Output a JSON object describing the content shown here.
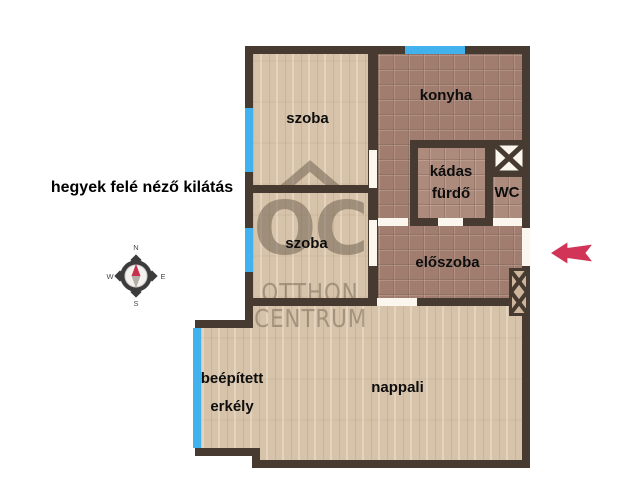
{
  "title": "floor-plan",
  "notes": {
    "view": "hegyek felé néző kilátás"
  },
  "rooms": {
    "szoba1": "szoba",
    "szoba2": "szoba",
    "konyha": "konyha",
    "furdo_line1": "kádas",
    "furdo_line2": "fürdő",
    "wc": "WC",
    "eloszoba": "előszoba",
    "nappali": "nappali",
    "erkely_line1": "beépített",
    "erkely_line2": "erkély"
  },
  "compass": {
    "n": "N",
    "e": "E",
    "s": "S",
    "w": "W"
  },
  "watermark": {
    "logo": "OC",
    "line1": "OTTHON",
    "line2": "CENTRUM"
  },
  "icons": {
    "entrance_arrow": "left-arrow",
    "shaft_top": "x-box-shaft",
    "shaft_right": "x-box-shaft",
    "compass_needle": "north-needle"
  },
  "colors": {
    "wall": "#473a30",
    "window": "#41b2ee",
    "wood_floor": "#d7c3a9",
    "tile_floor": "#a17d6f",
    "door_opening": "#fbf7ee",
    "entrance_arrow": "#d23457",
    "background": "#ffffff"
  }
}
